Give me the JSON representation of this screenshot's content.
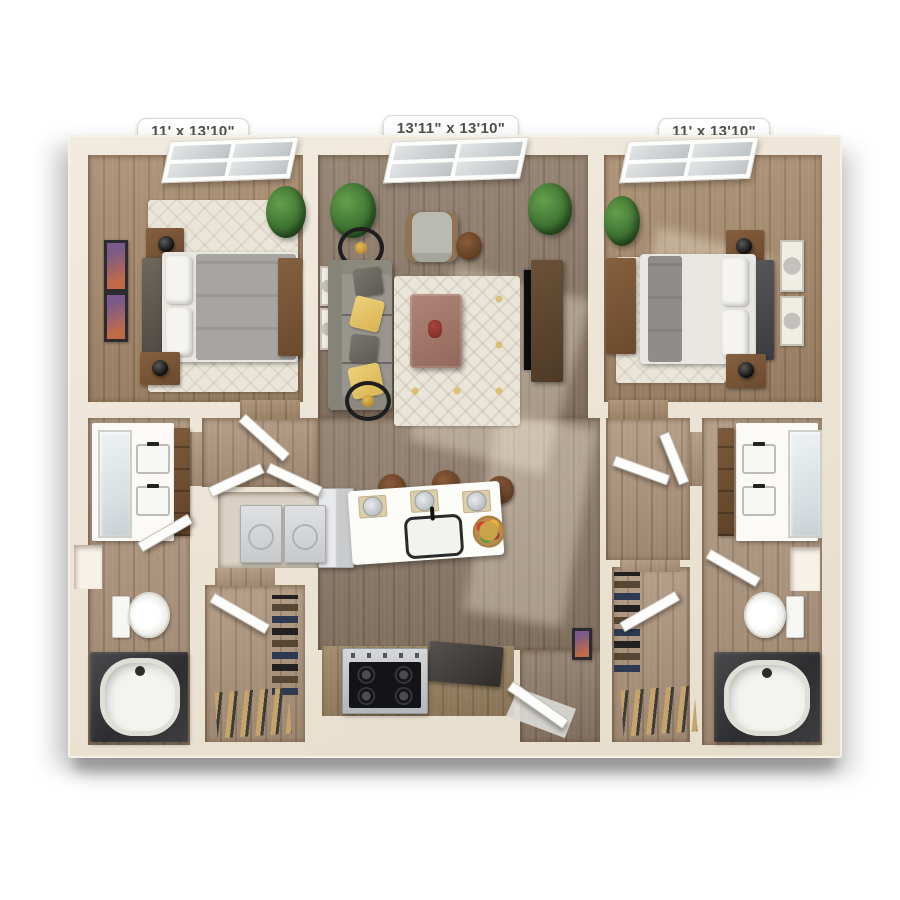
{
  "floor_plan": {
    "dimension_labels": [
      {
        "id": "bedroom-left",
        "text": "11' x 13'10\""
      },
      {
        "id": "living-room",
        "text": "13'11\" x 13'10\""
      },
      {
        "id": "bedroom-right",
        "text": "11' x 13'10\""
      }
    ],
    "palette": {
      "wall_cream": "#ece4d5",
      "wood_floor": "#97805f",
      "wood_floor_grey": "#8d7a68",
      "rug_cream": "#eae5d9",
      "sofa_grey": "#97958d",
      "accent_pillow_yellow": "#e5c367",
      "plant_green": "#3f7433",
      "cabinet_wood": "#6b4a2e",
      "tub_deck_dark": "#3a3a3c",
      "counter_white": "#fcfcf9",
      "appliance_steel": "#c7c9cb",
      "label_text": "#514f4b"
    }
  }
}
